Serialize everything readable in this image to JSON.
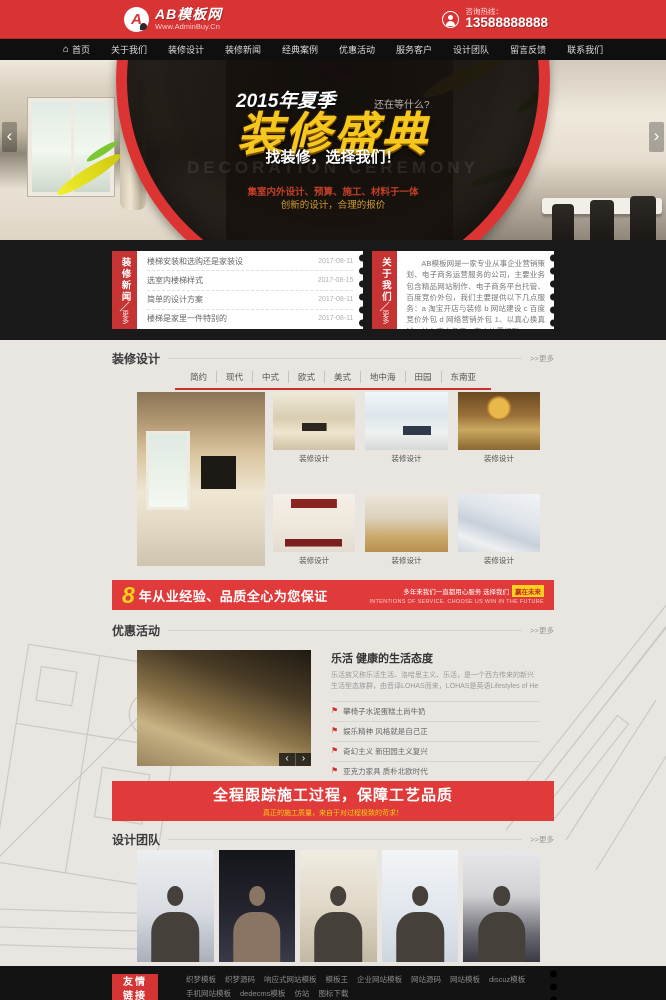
{
  "colors": {
    "accent_red": "#d93434",
    "banner_red": "#e03a3a",
    "gold": "#f6cf18",
    "dark": "#141414"
  },
  "header": {
    "logo_mark": "A",
    "logo_title": "AB模板网",
    "logo_subtitle": "Www.AdminBuy.Cn",
    "hotline_label": "咨询热线：",
    "hotline_number": "13588888888"
  },
  "nav": {
    "items": [
      "首页",
      "关于我们",
      "装修设计",
      "装修新闻",
      "经典案例",
      "优惠活动",
      "服务客户",
      "设计团队",
      "留言反馈",
      "联系我们"
    ]
  },
  "hero": {
    "season": "2015年夏季",
    "wait": "还在等什么?",
    "title": "装修盛典",
    "subtitle": "找装修，选择我们！",
    "watermark": "DECORATION CEREMONY",
    "line1": "集室内外设计、预算、施工、材料于一体",
    "line2": "创新的设计，合理的报价",
    "prev": "‹",
    "next": "›"
  },
  "news": {
    "tab": "装修新闻",
    "more": "更多",
    "items": [
      {
        "title": "楼梯安装和选购还是家装设",
        "date": "2017-08-11"
      },
      {
        "title": "选室内楼梯样式",
        "date": "2017-08-15"
      },
      {
        "title": "简单的设计方案",
        "date": "2017-08-11"
      },
      {
        "title": "楼梯是家里一件特别的",
        "date": "2017-08-11"
      }
    ]
  },
  "about": {
    "tab": "关于我们",
    "more": "更多",
    "text": "AB模板网是一家专业从事企业营销策划、电子商务运营服务的公司，主要业务包含精品网站制作、电子商务平台托管、百度竞价外包，我们主要提供以下几点服务：a 淘宝开店与装修 b 网站建设 c 百度竞价外包 d 网络营销外包 1、以真心换真诚，站在客户角度，客户的需想到。"
  },
  "design": {
    "title": "装修设计",
    "more": ">>更多",
    "tabs": [
      "简约",
      "现代",
      "中式",
      "欧式",
      "美式",
      "地中海",
      "田园",
      "东南亚"
    ],
    "caption": "装修设计"
  },
  "banner1": {
    "num": "8",
    "text": "年从业经验、品质全心为您保证",
    "right_line1": "多年来我们一直都用心服务 选择我们",
    "badge": "赢在未来",
    "right_line2": "INTENTIONS OF SERVICE. CHOOSE US WIN IN THE FUTURE"
  },
  "offers": {
    "title": "优惠活动",
    "more": ">>更多",
    "article_title": "乐活 健康的生活态度",
    "article_text": "乐活族又称乐活生活、洛哈思主义、乐活，是一个西方传来的新兴生活型态族群，由音译LOHAS而来，LOHAS是英语Lifestyles of He",
    "items": [
      "攀椅子水泥蛋糕土尚牛奶",
      "娱乐精神 风格就是自己正",
      "奇幻主义 新田园主义复兴",
      "亚克力家具 质朴北欧时代"
    ],
    "prev": "‹",
    "next": "›"
  },
  "banner2": {
    "title": "全程跟踪施工过程，保障工艺品质",
    "subtitle": "真正的施工质量，来自于对过程极致的苛求！"
  },
  "team": {
    "title": "设计团队",
    "more": ">>更多"
  },
  "footer": {
    "tab_line1": "友情",
    "tab_line2": "链接",
    "links": [
      "织梦模板",
      "织梦源码",
      "响应式网站模板",
      "模板王",
      "企业网站模板",
      "网站源码",
      "网站模板",
      "discuz模板",
      "手机网站模板",
      "dedecms模板",
      "仿站",
      "图标下载"
    ]
  }
}
